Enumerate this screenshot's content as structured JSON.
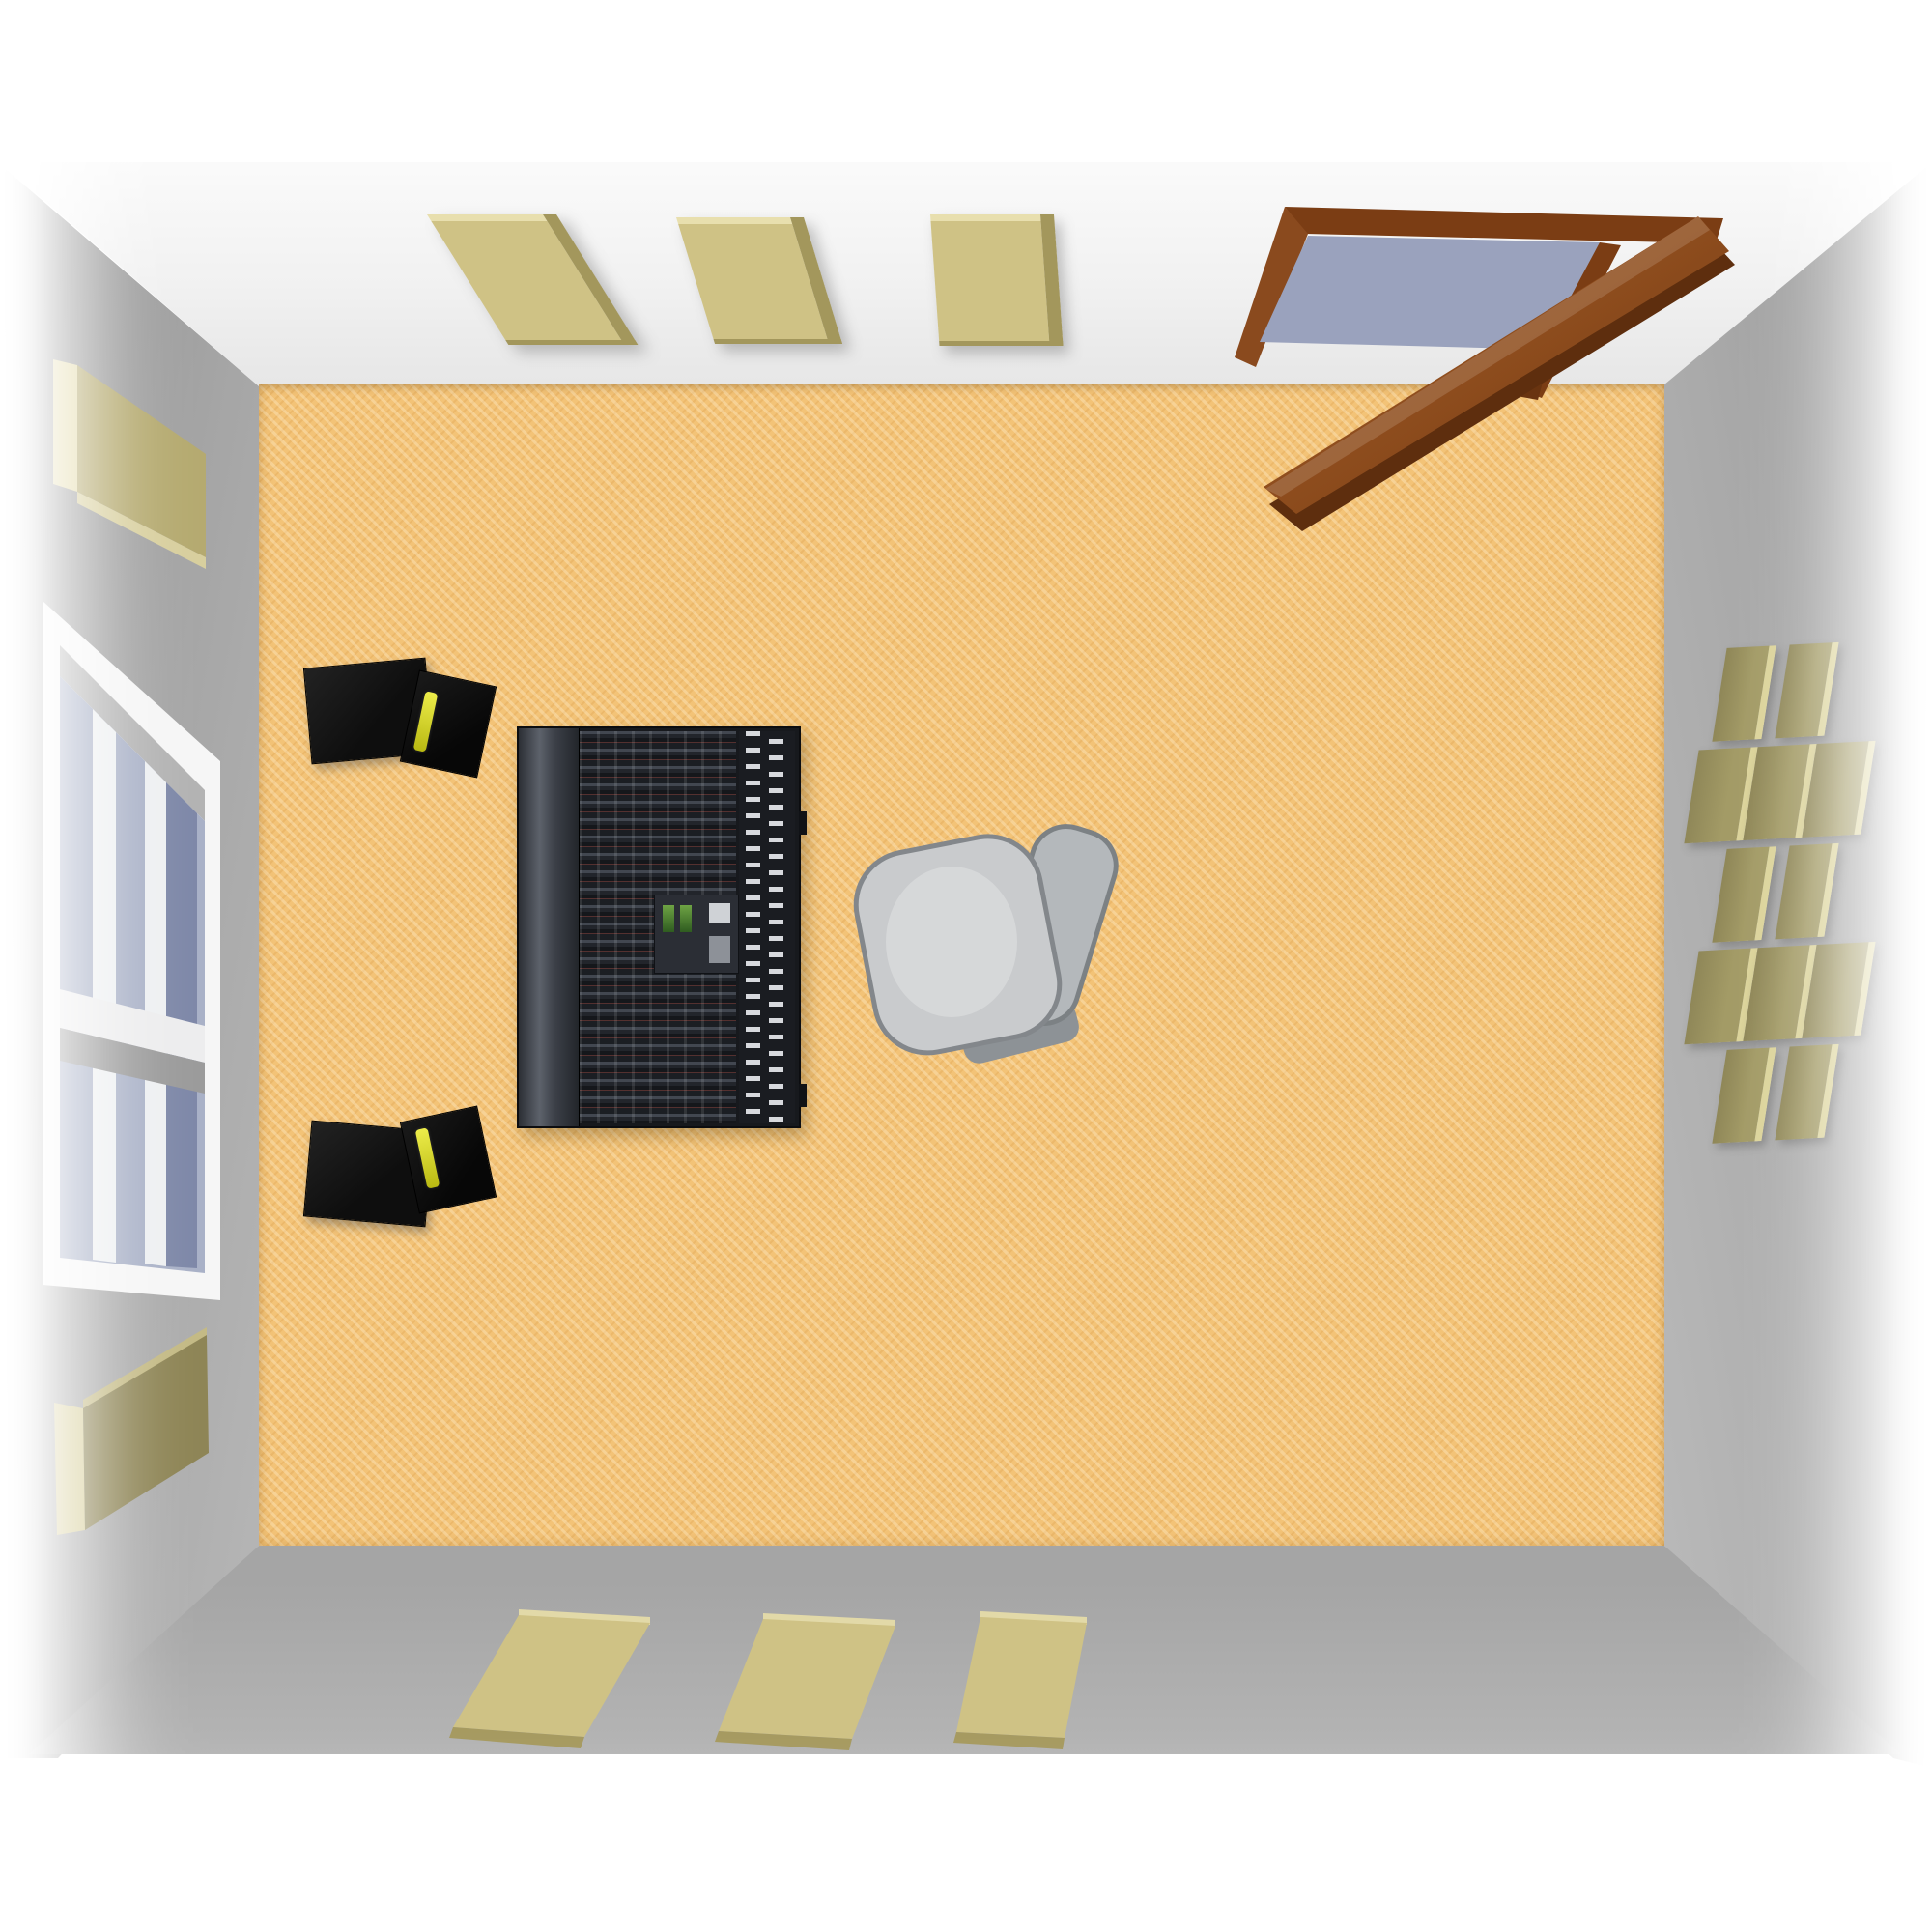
{
  "page": {
    "title": "Recording studio control room - top-down 3D view"
  },
  "colors": {
    "carpet": "#f3c377",
    "wallside": "#9c9c9c",
    "walltop": "#ededed",
    "wallbottom": "#aaaaaa",
    "panelface": "#cfc285",
    "paneledge": "#a3975c",
    "panelhighlight": "#e8dfae",
    "diffuserface": "#a39b66",
    "diffuseredge": "#dcd49b",
    "doorwood": "#8a4a1e",
    "doorwooddark": "#5e2e0e",
    "doorway": "#9aa2bd",
    "glass": "#a9b1c7",
    "windowframe": "#f6f6f6",
    "speaker": "#121212",
    "driveryellow": "#b9b912",
    "console": "#17191d",
    "chairseat": "#c9cbcd",
    "chairframe": "#83878b"
  },
  "scene": {
    "description": "Top-down 3D rendering of a rectangular studio room with orange carpet, gray walls, acoustic treatment, mixing console, two studio monitors, office chair, window and an open wooden door",
    "room": {
      "floor": "orange carpet",
      "side_walls": "gray",
      "top_wall": "white"
    },
    "objects": {
      "door": {
        "label": "Open wooden door",
        "state": "open"
      },
      "doorway": {
        "label": "Doorway opening"
      },
      "window": {
        "label": "Window on left wall"
      },
      "mixing_console": {
        "label": "Mixing console with fader banks"
      },
      "chair": {
        "label": "Office chair"
      },
      "monitor_upper": {
        "label": "Studio monitor speaker (upper)"
      },
      "monitor_lower": {
        "label": "Studio monitor speaker (lower)"
      },
      "top_wall_panels": {
        "label": "Acoustic absorber panel",
        "count": 3
      },
      "bottom_wall_panels": {
        "label": "Acoustic absorber panel",
        "count": 3
      },
      "left_wall_panels": {
        "label": "Acoustic absorber panel",
        "count": 2
      },
      "right_wall_diffuser": {
        "label": "Checkerboard diffuser array",
        "count": 12
      }
    }
  }
}
